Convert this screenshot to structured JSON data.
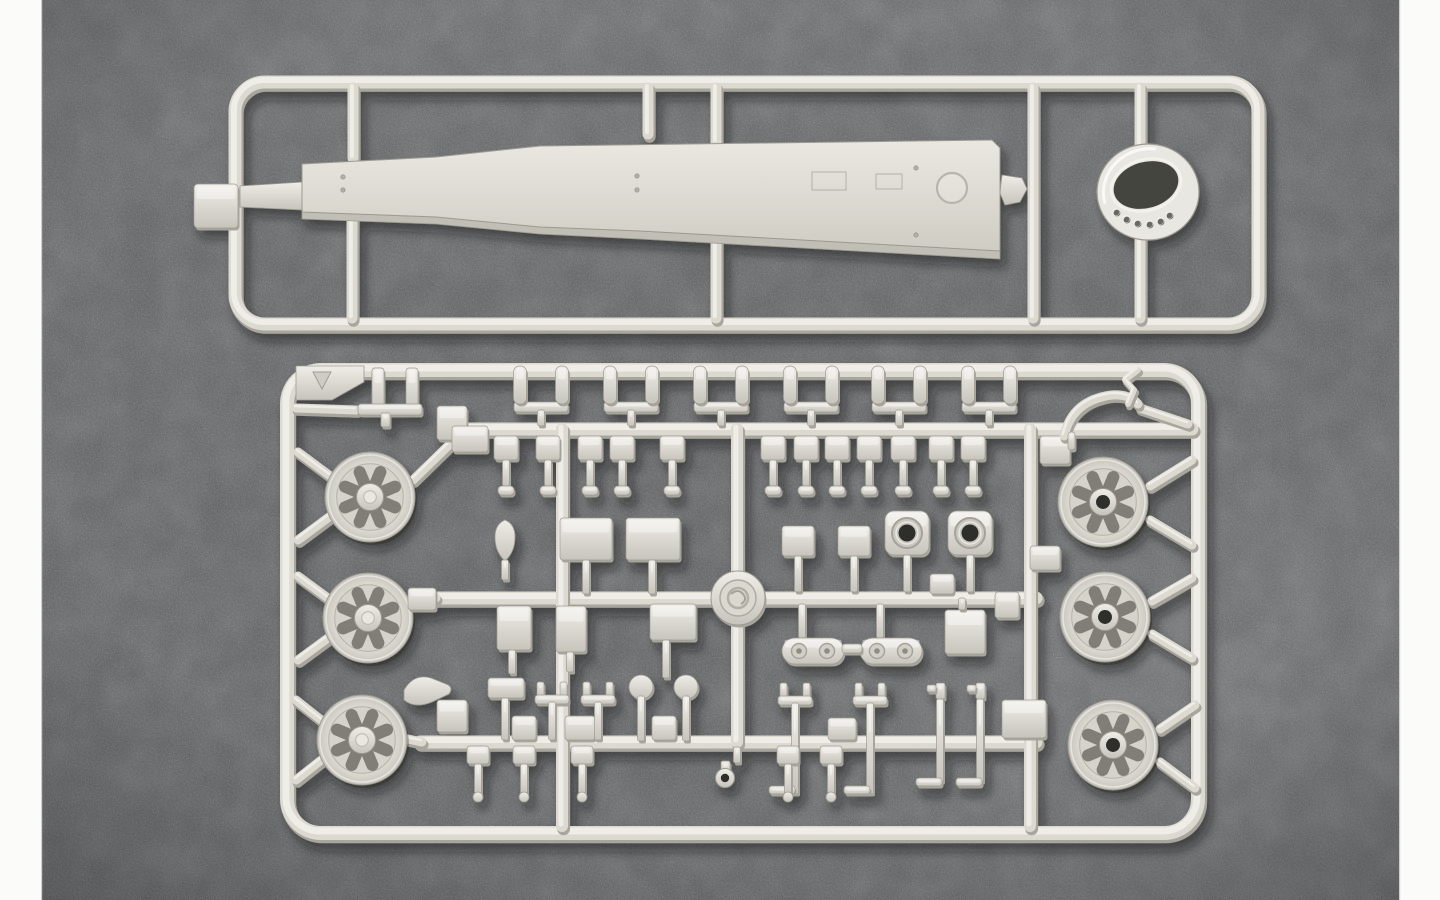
{
  "meta": {
    "description": "Photograph of two light-gray injection-molded plastic model kit sprues lying on a dark speckled gray fabric surface, framed by white vertical bars on the left and right edges. The top sprue is a long rectangular frame holding one long tapered hull beam part and one turret-ring part with drilled holes. The bottom sprue is a large rectangular frame holding six spoked road wheels (three per side), a round manufacturer medallion at the center crossing, and dozens of small fittings, pegs, brackets and boxes on inner runners."
  },
  "palette": {
    "white_bar": "#fbfbfa",
    "bg": "#57595b",
    "bg_light": "#6e7173",
    "bg_dark": "#3e4042",
    "plastic": "#dcd9d1",
    "plastic_hi": "#efede7",
    "plastic_lo": "#a8a59d",
    "plastic_line": "#9d9a92",
    "part_side": "#c1beb6",
    "spoke": "#817e77",
    "hole": "#2f2e2a",
    "ring_hole": "#454440"
  },
  "layout": {
    "w": 1440,
    "h": 900,
    "left_bar_w": 42,
    "right_bar_x": 1399,
    "right_bar_w": 41
  },
  "top_sprue": {
    "frame": {
      "x": 235,
      "y": 82,
      "x2": 1258,
      "y2": 324,
      "r": 30,
      "t": 13
    },
    "tab": [
      194,
      184,
      44,
      44
    ],
    "stubs": [
      [
        353,
        88,
        353,
        158
      ],
      [
        648,
        88,
        648,
        134
      ],
      [
        716,
        88,
        716,
        142
      ],
      [
        1033,
        88,
        1033,
        318
      ],
      [
        1140,
        88,
        1140,
        152
      ],
      [
        352,
        208,
        352,
        318
      ],
      [
        716,
        230,
        716,
        318
      ],
      [
        1140,
        238,
        1140,
        318
      ]
    ],
    "neck": "M240,186 L303,182 L303,210 L240,207 Z",
    "part": {
      "top": "M302,164 L436,157 L540,146 L992,140 L1000,148 L1000,251 L640,231 L540,227 L436,217 L302,212 Z",
      "side": "M302,212 L436,217 L540,227 L640,231 L1000,251 L1000,259 L640,239 L540,234 L436,224 L302,219 Z",
      "rivets": [
        [
          343,
          177
        ],
        [
          343,
          190
        ],
        [
          637,
          176
        ],
        [
          637,
          190
        ],
        [
          916,
          168
        ],
        [
          916,
          235
        ]
      ],
      "circle": {
        "cx": 952,
        "cy": 188,
        "r": 15
      },
      "panels": [
        [
          812,
          172,
          34,
          18
        ],
        [
          876,
          174,
          26,
          15
        ]
      ]
    },
    "clip": "M1002,175 l20,3 l5,11 l-7,13 l-15,3 l-5,-12 Z",
    "ring": {
      "cx": 1148,
      "cy": 192,
      "rx": 51,
      "ry": 48,
      "open": {
        "cx": 1146,
        "cy": 185,
        "rx": 33,
        "ry": 23,
        "rot": -16
      },
      "holes": [
        [
          1117,
          213
        ],
        [
          1127,
          220
        ],
        [
          1138,
          224
        ],
        [
          1150,
          225
        ],
        [
          1161,
          222
        ],
        [
          1170,
          216
        ]
      ]
    }
  },
  "bottom_sprue": {
    "frame": {
      "x": 287,
      "y": 370,
      "x2": 1198,
      "y2": 833,
      "r": 34,
      "t": 14
    },
    "corner_plate": "M296,366 L364,366 L364,382 L332,400 L296,400 Z",
    "tri_mark": "M313,372 L331,372 L322,389 Z",
    "rails": [
      [
        465,
        429,
        1192,
        429
      ],
      [
        432,
        598,
        1036,
        598
      ],
      [
        420,
        742,
        1036,
        742
      ]
    ],
    "verticals": [
      [
        562,
        429,
        562,
        826
      ],
      [
        737,
        429,
        737,
        742
      ],
      [
        1030,
        429,
        1030,
        826
      ]
    ],
    "runners": [
      [
        298,
        452,
        333,
        478
      ],
      [
        298,
        540,
        333,
        514
      ],
      [
        298,
        576,
        332,
        601
      ],
      [
        298,
        660,
        332,
        635
      ],
      [
        296,
        700,
        325,
        723
      ],
      [
        296,
        780,
        325,
        757
      ],
      [
        1192,
        460,
        1150,
        486
      ],
      [
        1192,
        545,
        1150,
        520
      ],
      [
        1192,
        578,
        1152,
        601
      ],
      [
        1192,
        658,
        1152,
        634
      ],
      [
        1195,
        705,
        1160,
        729
      ],
      [
        1195,
        788,
        1160,
        762
      ],
      [
        296,
        408,
        356,
        410
      ],
      [
        413,
        480,
        452,
        442
      ],
      [
        411,
        600,
        436,
        598
      ],
      [
        403,
        738,
        422,
        742
      ],
      [
        1140,
        408,
        1188,
        424
      ]
    ],
    "wheels_left": [
      [
        370,
        497,
        45
      ],
      [
        368,
        618,
        45
      ],
      [
        362,
        740,
        45
      ]
    ],
    "wheels_right": [
      [
        1103,
        502,
        45
      ],
      [
        1105,
        617,
        45
      ],
      [
        1113,
        745,
        45
      ]
    ],
    "logo": {
      "cx": 738,
      "cy": 598,
      "r": 27
    },
    "peg_pairs": {
      "centers": [
        541,
        631,
        721,
        811,
        899,
        989
      ],
      "offset": 21,
      "top": 366,
      "peg_h": 38,
      "bar_y": 402,
      "bar_h": 10,
      "stem_bot": 426
    },
    "pi_part": {
      "v1": [
        372,
        368,
        12,
        44
      ],
      "v2": [
        406,
        368,
        12,
        44
      ],
      "bar": [
        358,
        404,
        64,
        11
      ],
      "leg": [
        381,
        413,
        9,
        14
      ]
    },
    "brackets": [
      506,
      548,
      590,
      622,
      672,
      773,
      806,
      837,
      869,
      903,
      941,
      973
    ],
    "teardrop": {
      "path": "M505,520 q10,4 10,17 q0,15 -10,24 q-10,-9 -10,-24 q0,-13 10,-17 Z",
      "leg": [
        505,
        560,
        580
      ]
    },
    "boxes": [
      [
        560,
        518,
        52,
        42
      ],
      [
        626,
        518,
        54,
        42
      ],
      [
        782,
        526,
        32,
        30
      ],
      [
        838,
        526,
        32,
        30
      ],
      [
        497,
        606,
        34,
        44
      ],
      [
        556,
        606,
        30,
        46
      ],
      [
        650,
        604,
        46,
        36
      ],
      [
        945,
        610,
        40,
        44
      ],
      [
        437,
        406,
        30,
        34
      ],
      [
        452,
        426,
        36,
        26
      ],
      [
        408,
        588,
        28,
        22
      ],
      [
        437,
        700,
        30,
        32
      ],
      [
        1040,
        436,
        30,
        28
      ],
      [
        1030,
        546,
        30,
        24
      ],
      [
        1002,
        700,
        44,
        38
      ],
      [
        995,
        592,
        24,
        26
      ],
      [
        930,
        574,
        24,
        20
      ],
      [
        488,
        678,
        36,
        20
      ],
      [
        512,
        716,
        24,
        24
      ],
      [
        565,
        716,
        30,
        24
      ],
      [
        652,
        716,
        24,
        24
      ],
      [
        828,
        718,
        28,
        22
      ]
    ],
    "circle_squares": [
      [
        885,
        511,
        44
      ],
      [
        948,
        511,
        44
      ]
    ],
    "legs": [
      [
        586,
        560,
        594
      ],
      [
        652,
        560,
        594
      ],
      [
        798,
        556,
        592
      ],
      [
        854,
        556,
        592
      ],
      [
        907,
        555,
        592
      ],
      [
        970,
        555,
        592
      ],
      [
        512,
        650,
        674
      ],
      [
        570,
        652,
        672
      ],
      [
        666,
        640,
        678
      ],
      [
        962,
        598,
        610
      ],
      [
        802,
        604,
        638
      ],
      [
        880,
        604,
        638
      ],
      [
        505,
        698,
        740
      ]
    ],
    "capsules": [
      [
        782,
        638,
        62,
        26
      ],
      [
        860,
        638,
        62,
        26
      ]
    ],
    "link_bar": [
      842,
      644,
      20,
      9
    ],
    "forks": [
      {
        "c": 552,
        "top": 682,
        "bot": 740
      },
      {
        "c": 598,
        "top": 682,
        "bot": 740
      },
      {
        "c": 795,
        "top": 683,
        "bot": 794,
        "foot": -26
      },
      {
        "c": 870,
        "top": 683,
        "bot": 794,
        "foot": -26
      }
    ],
    "ball_heads": [
      [
        641,
        687
      ],
      [
        686,
        687
      ]
    ],
    "nozzles": [
      940,
      980
    ],
    "lower_brackets": [
      478,
      524,
      582,
      788,
      831
    ],
    "keyhole": {
      "stub": [
        737,
        747,
        763
      ],
      "stem": [
        721,
        761,
        9,
        13
      ],
      "cx": 725,
      "cy": 778,
      "r": 9.5,
      "hole_r": 4.2
    },
    "wing": "M404,690 q10,-17 27,-12 l15,6 q8,3 3,10 l-17,8 q-17,7 -28,-2 Z",
    "fender": {
      "arc": "M1064,436 Q1072,400 1112,395 Q1130,394 1138,404",
      "hook": "M1128,404 l6,-14 l-9,-10 l13,-10",
      "needle": [
        1068,
        432,
        7,
        18
      ]
    }
  }
}
